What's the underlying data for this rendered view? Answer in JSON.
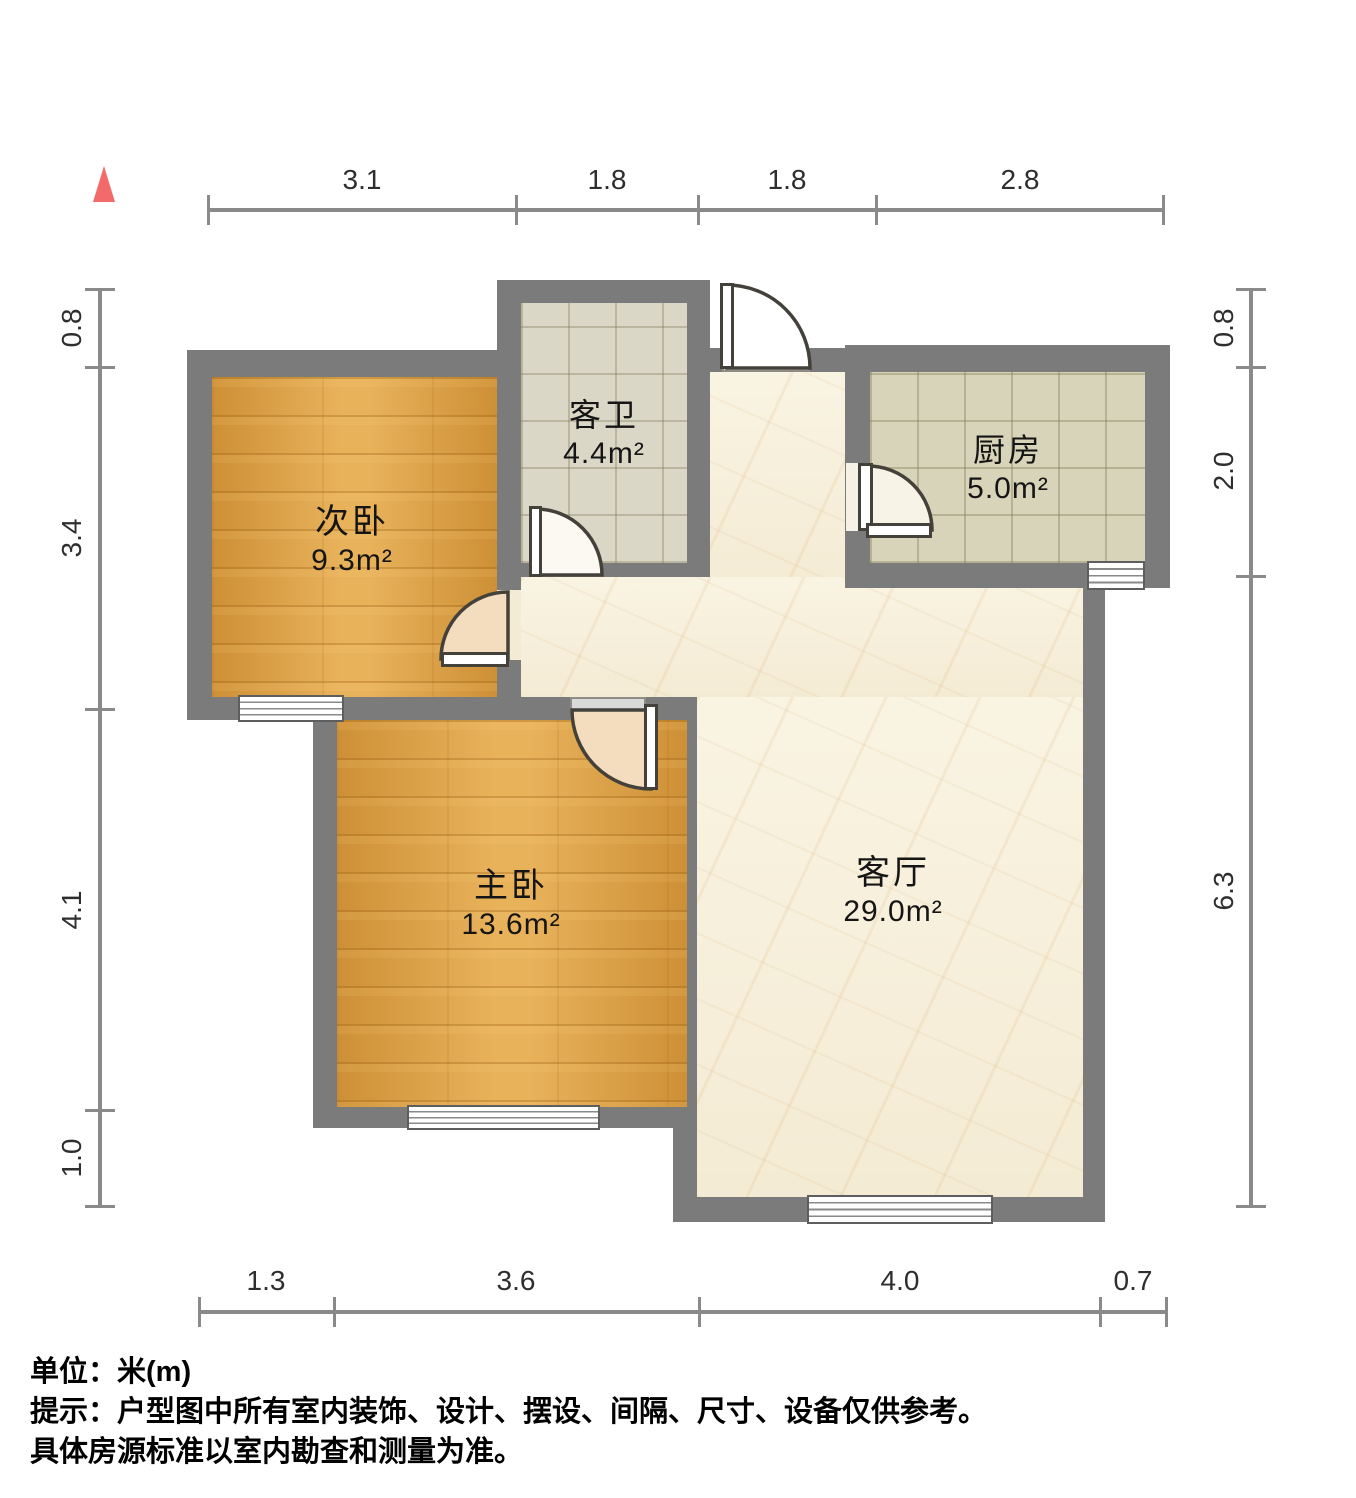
{
  "plan": {
    "rooms": [
      {
        "id": "secondary-bedroom",
        "name": "次卧",
        "area": "9.3m²"
      },
      {
        "id": "guest-bathroom",
        "name": "客卫",
        "area": "4.4m²"
      },
      {
        "id": "kitchen",
        "name": "厨房",
        "area": "5.0m²"
      },
      {
        "id": "master-bedroom",
        "name": "主卧",
        "area": "13.6m²"
      },
      {
        "id": "living-room",
        "name": "客厅",
        "area": "29.0m²"
      }
    ],
    "dimensions": {
      "top": [
        "3.1",
        "1.8",
        "1.8",
        "2.8"
      ],
      "bottom": [
        "1.3",
        "3.6",
        "4.0",
        "0.7"
      ],
      "left": [
        "0.8",
        "3.4",
        "4.1",
        "1.0"
      ],
      "right": [
        "0.8",
        "2.0",
        "6.3"
      ]
    }
  },
  "footer": {
    "unit": "单位：米(m)",
    "tip1": "提示：户型图中所有室内装饰、设计、摆设、间隔、尺寸、设备仅供参考。",
    "tip2": "具体房源标准以室内勘查和测量为准。"
  },
  "colors": {
    "wall": "#7b7b7b",
    "wood_floor": "#e0a040",
    "bath_tile": "#dbd7c6",
    "kitchen_tile": "#d8d4b9",
    "marble_floor": "#f4ebd4",
    "marker_red": "#f26a6a",
    "dimension_line": "#8a8a8a"
  }
}
